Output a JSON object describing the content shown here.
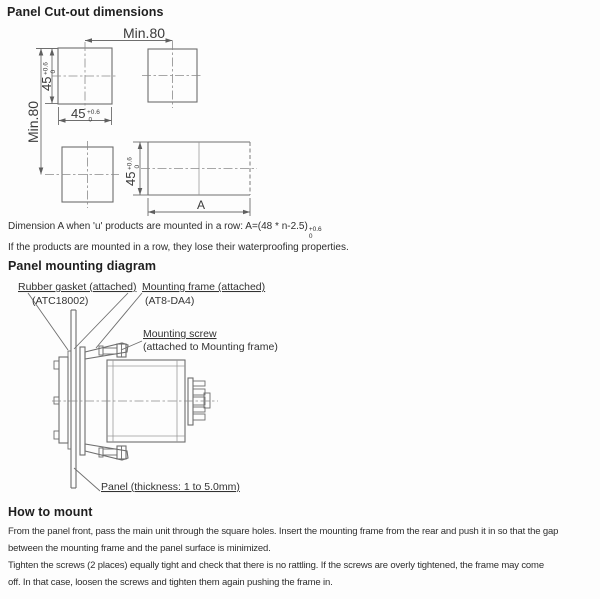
{
  "headings": {
    "cutout": "Panel Cut-out dimensions",
    "mounting": "Panel mounting diagram",
    "how": "How to mount"
  },
  "cutout": {
    "min80": "Min.80",
    "forty_five": "45",
    "tol_plus": "+0.6",
    "tol_zero": "0",
    "dim_a": "A"
  },
  "notes": {
    "line1": "Dimension A when 'u' products are mounted in a row: A=(48 * n-2.5)",
    "tol_plus": "+0.6",
    "tol_zero": "0",
    "line2": "If the products are mounted in a row, they lose their waterproofing properties."
  },
  "mounting": {
    "labels": {
      "rubber_gasket": "Rubber gasket (attached)",
      "rubber_gasket_part": "(ATC18002)",
      "frame": "Mounting frame (attached)",
      "frame_part": "(AT8-DA4)",
      "screw": "Mounting screw",
      "screw_note": "(attached to Mounting frame)",
      "panel": "Panel (thickness: 1 to 5.0mm)"
    }
  },
  "how_to_mount": {
    "lines": [
      "From the panel front, pass the main unit through the square holes. Insert the mounting frame from the rear and push it in so that the gap",
      "between the mounting frame and the panel surface is minimized.",
      "Tighten the screws (2 places) equally tight and check that there is no rattling. If the screws are overly tightened, the frame may come",
      "off. In that case, loosen the screws and tighten them again pushing the frame in."
    ]
  },
  "colors": {
    "line": "#6e6e6e",
    "text": "#333333",
    "background": "#fdfdfd"
  }
}
